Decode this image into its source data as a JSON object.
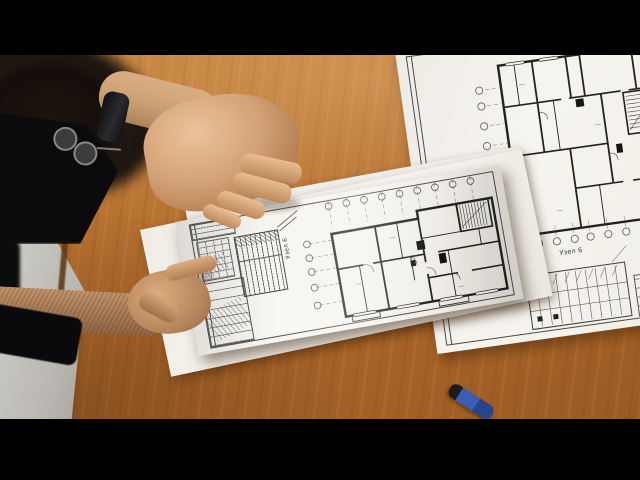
{
  "labels": {
    "held_sheet_node": "Узел 6",
    "right_sheet_node": "Узел 6"
  },
  "colors": {
    "letterbox": "#000000",
    "desk_wood": "#b26c2d",
    "desk_highlight": "#c5823b",
    "desk_shadow": "#9a5a22",
    "floor_gray": "#bfbdb6",
    "paper_white": "#f5f3ed",
    "drawing_ink": "#2a2a2a",
    "skin_light": "#ecc39a",
    "skin_dark": "#8f6542",
    "clothing_black": "#0b0b0d",
    "hair_brown": "#1c140e",
    "watch_band": "#0d0d0f",
    "pen_blue": "#3a5fb0"
  }
}
